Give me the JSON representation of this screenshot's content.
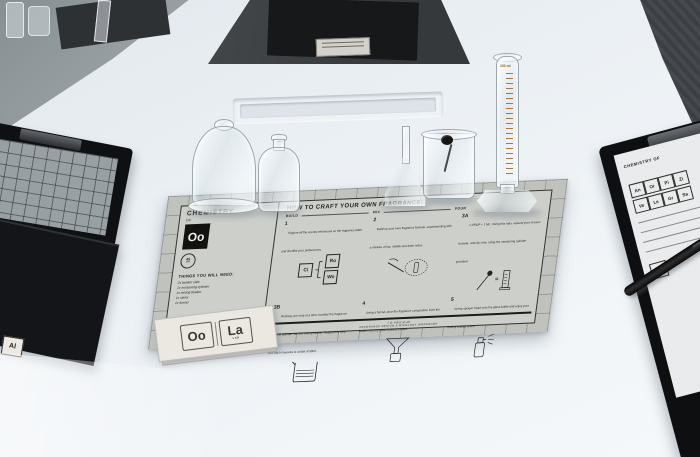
{
  "placemat": {
    "brand": {
      "title": "CHEMISTRY",
      "of": "OF",
      "element": "Oo"
    },
    "badge": {
      "value": "45",
      "unit": "MIN"
    },
    "needs": {
      "title": "THINGS YOU WILL NEED:",
      "items": [
        "2x beaker vials",
        "1x measuring cylinder",
        "1x mixing beaker",
        "1x stirrer",
        "1x funnel"
      ]
    },
    "howto": {
      "title": "HOW TO CRAFT YOUR OWN FRAGRANCE:",
      "phases": [
        "BUILD",
        "MIX",
        "POUR"
      ],
      "tiles": [
        {
          "symbol": "Ci"
        },
        {
          "symbol": "Ro"
        },
        {
          "symbol": "Wo"
        }
      ],
      "equals_sign": "=",
      "steps": [
        {
          "num": "1",
          "text": "Explore all the scents referenced on the fragrance table and shortlist your preferences."
        },
        {
          "num": "2",
          "text": "Build up your own fragrance formula, experimenting with a mixture of top, middle and base notes."
        },
        {
          "num": "3A",
          "text": "1 DROP = 1 ML. Using this ratio, expand your chosen formula, note by note, using the measuring cylinder provided."
        },
        {
          "num": "3B",
          "text": "Working one note at a time, transfer the fragrance from the cylinder into the mixing beaker. Repeat this step until each measure is a total of 30ml."
        },
        {
          "num": "4",
          "text": "Using a funnel, pour the fragrance composition from the beaker into the glass bottle provided."
        },
        {
          "num": "5",
          "text": "Crimp sprayer head onto the glass bottle and enjoy your freshly crafted scent!"
        }
      ]
    },
    "footer": {
      "line1": "f ◎ #OoLaLab",
      "line2": "FRAGRANCE DESIGN & MIXOLOGY WORKSHOP"
    }
  },
  "cards": {
    "tile1": "Oo",
    "tile2": "La",
    "subtext": "LAB"
  },
  "cylinder": {
    "label": "100 ml"
  },
  "right_clipboard": {
    "heading": "CHEMISTRY OF",
    "element": "Oo",
    "tiles": [
      "An",
      "Or",
      "Pi",
      "Zi",
      "Ve",
      "Le",
      "Gr",
      "Sa"
    ],
    "lower_tile": "Fu"
  },
  "left_clipboard": {
    "tile": "Al"
  },
  "colors": {
    "placemat": "#c3c5c0",
    "ink": "#26261f",
    "table": "#eef2f6",
    "amber": "#a8712f"
  }
}
